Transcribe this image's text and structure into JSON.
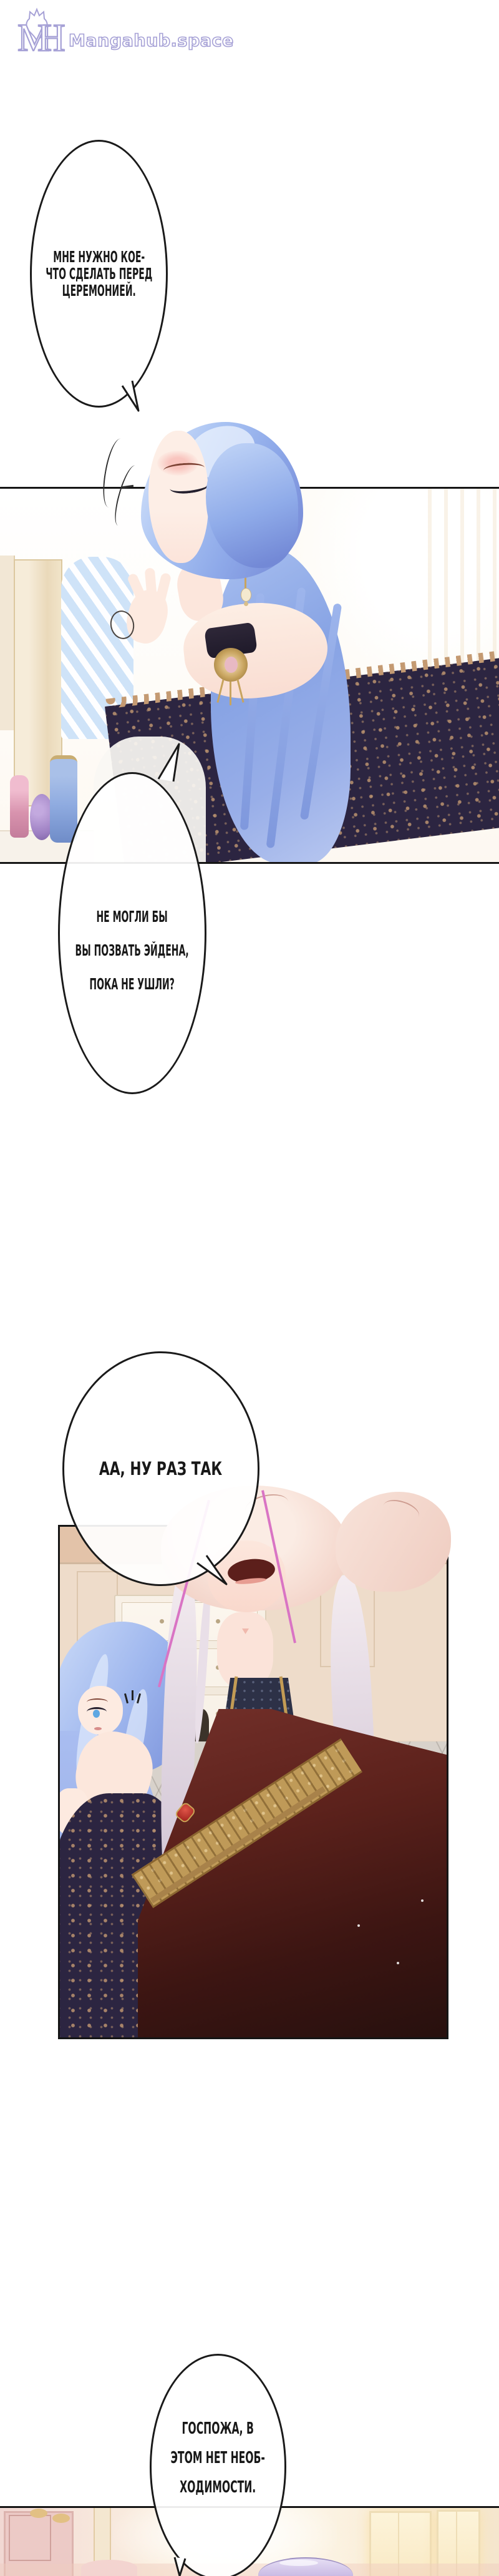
{
  "watermark": {
    "monogram_m": "M",
    "monogram_h": "H",
    "site_name": "Mangahub.space",
    "color": "#a6a1d6"
  },
  "bubbles": {
    "b1": {
      "lines": [
        "МНЕ НУЖНО КОЕ-",
        "ЧТО СДЕЛАТЬ ПЕРЕД",
        "ЦЕРЕМОНИЕЙ."
      ]
    },
    "b2": {
      "lines": [
        "НЕ МОГЛИ БЫ",
        "ВЫ ПОЗВАТЬ ЭЙДЕНА,",
        "ПОКА НЕ УШЛИ?"
      ]
    },
    "b3": {
      "lines": [
        "АА, НУ РАЗ ТАК"
      ]
    },
    "b4": {
      "lines": [
        "ГОСПОЖА, В",
        "ЭТОМ НЕТ НЕОБ-",
        "ХОДИМОСТИ."
      ]
    }
  },
  "palette": {
    "logo_lavender": "#a6a1d6",
    "line_black": "#1a1a1a",
    "border_gray_through_bubble": "#c8c8c8",
    "hair_blue": "#8fabe9",
    "skin": "#fdeee6",
    "dress_navy": "#2c2541",
    "dress_gold": "#c49a72",
    "robe_maroon": "#5d221c",
    "collar_navy": "#2d3147",
    "man_hair_pink": "#f6dcd2",
    "silver_hair": "#ddd2de",
    "wall_beige": "#eedcca",
    "floor_gray": "#d8d2cb",
    "room3_pink": "#f1d8d3",
    "aiden_hair_lavender": "#c7b8e3"
  }
}
